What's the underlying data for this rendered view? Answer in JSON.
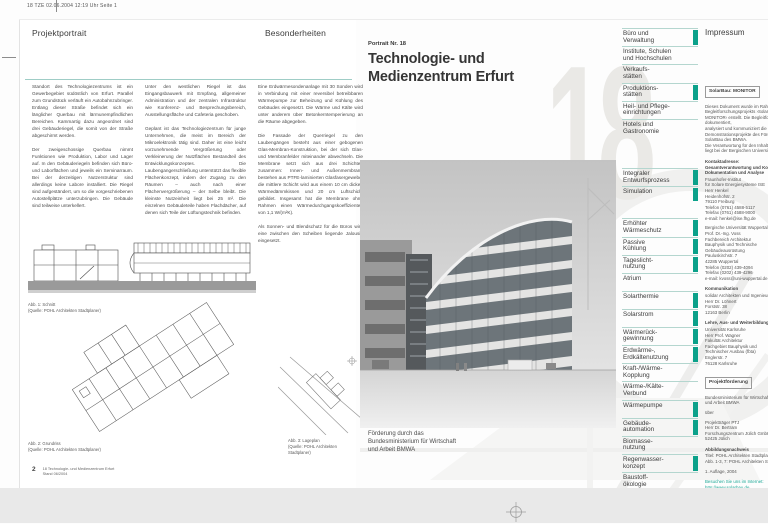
{
  "meta": {
    "print_info": "18 TZE 02.06.2004 12:19 Uhr Seite 1"
  },
  "colors": {
    "accent_green": "#0ba18a",
    "hairline_teal": "#9fcdc6",
    "link_teal": "#1aa795",
    "watermark_gray": "#eae9e6",
    "desk_gray": "#e9e9e9"
  },
  "left_page": {
    "header_left": "Projektportrait",
    "header_right": "Besonderheiten",
    "col1": {
      "p1": "Standort des Technologiezentrums ist ein Gewerbegebiet südöstlich von Erfurt. Parallel zum Grundstück verläuft ein Autobahnzubringer. Entlang dieser Straße befindet sich ein länglicher Querbau mit lärmunempfindlichen Bereichen. Kammartig dazu angeordnet sind drei Gebäuderiegel, die somit von der Straße abgeschirmt werden.",
      "p2": "Der zweigeschossige Querbau nimmt Funktionen wie Produktion, Labor und Lager auf. In den Gebäuderiegeln befinden sich Büro- und Laborflächen und jeweils ein Seminarraum. Bei der derzeitigen Nutzerstruktur sind allerdings keine Labore installiert. Die Riegel sind aufgeständert, um so die vorgeschriebenen Autostellplätze unterzubringen. Die Gebäude sind teilweise unterkellert."
    },
    "col2": {
      "p1": "Unter den westlichen Riegel ist das Eingangsbauwerk mit Empfang, allgemeiner Administration und der zentralen Infrastruktur wie Konferenz- und Besprechungsbereich, Ausstellungsfläche und Cafeteria geschoben.",
      "p2": "Geplant ist das Technologiezentrum für junge Unternehmen, die meist im Bereich der Mikroelektronik tätig sind. Daher ist eine leicht vorzunehmende Vergrößerung oder Verkleinerung der Nutzflächen Bestandteil des Entwicklungskonzeptes. Die Laubengangerschließung unterstützt das flexible Flächenkonzept, indem der Zugang zu den Räumen – auch nach einer Flächenvergrößerung – der Selbe bleibt. Die kleinste Nutzeinheit liegt bei 25 m². Die einzelnen Gebäudeteile haben Flachdächer, auf denen sich Teile der Lüftungstechnik befinden."
    },
    "col3": {
      "p1": "Eine Erdwärmesondenanlage mit 30 Sonden wird in Verbindung mit einer reversibel betreibbaren Wärmepumpe zur Beheizung und Kühlung des Gebäudes eingesetzt. Die Wärme und Kälte wird unter anderem über Betonkerntemperierung an die Räume abgegeben.",
      "p2": "Die Fassade der Querriegel zu den Laubengängen besteht aus einer gebogenen Glas-Membran-Konstruktion, bei der sich Glas- und Membranfelder miteinander abwechseln. Die Membrane setzt sich aus drei Schichten zusammen: Innen- und Außenmembrane bestehen aus PTFE-laminierten Glasfasergewebe, die mittlere Schicht wird aus einem 10 cm dicken Wärmedämmkissen und 20 cm Luftschicht gebildet. Insgesamt hat die Membrane ohne Rahmen einen Wärmedurchgangskoeffizienten von 1,1 W/(m²K).",
      "p3": "Als Sonnen- und Blendschutz für die Büros wird eine zwischen den Scheiben liegende Jalousie eingesetzt."
    },
    "fig1_caption": "Abb. 1: Schnitt\n(Quelle: POHL Architekten Stadtplaner)",
    "fig2_caption": "Abb. 2: Grundriss\n(Quelle: POHL Architekten Stadtplaner)",
    "fig3_caption": "Abb. 3: Lageplan\n(Quelle: POHL Architekten\nStadtplaner)",
    "page_number": "2",
    "footer_lines": "18 Technologie- und Medienzentrum Erfurt\nStand 06/2004"
  },
  "right_page": {
    "kicker": "Portrait Nr. 18",
    "title": "Technologie- und\nMedienzentrum Erfurt",
    "watermark": "18",
    "funding_note": "Förderung durch das\nBundesministerium für Wirtschaft\nund Arbeit BMWA"
  },
  "sidebar": {
    "building_types": [
      {
        "label": "Büro und\nVerwaltung",
        "active": true
      },
      {
        "label": "Institute, Schulen\nund Hochschulen",
        "active": false
      },
      {
        "label": "Verkaufs-\nstätten",
        "active": false
      },
      {
        "label": "Produktions-\nstätten",
        "active": true
      },
      {
        "label": "Heil- und Pflege-\neinrichtungen",
        "active": false
      },
      {
        "label": "Hotels und\nGastronomie",
        "active": false
      }
    ],
    "process": [
      {
        "label": "Integraler\nEntwurfsprozess",
        "active": true
      },
      {
        "label": "Simulation",
        "active": true
      }
    ],
    "features": [
      {
        "label": "Erhöhter\nWärmeschutz",
        "active": true
      },
      {
        "label": "Passive\nKühlung",
        "active": true
      },
      {
        "label": "Tageslicht-\nnutzung",
        "active": true
      },
      {
        "label": "Atrium",
        "active": false
      },
      {
        "label": "Solarthermie",
        "active": true
      },
      {
        "label": "Solarstrom",
        "active": true
      },
      {
        "label": "Wärmerück-\ngewinnung",
        "active": true
      },
      {
        "label": "Erdwärme-,\nErdkältenutzung",
        "active": true
      },
      {
        "label": "Kraft-/Wärme-\nKopplung",
        "active": false
      },
      {
        "label": "Wärme-/Kälte-\nVerbund",
        "active": false
      },
      {
        "label": "Wärmepumpe",
        "active": true
      },
      {
        "label": "Gebäude-\nautomation",
        "active": true
      },
      {
        "label": "Biomasse-\nnutzung",
        "active": false
      },
      {
        "label": "Regenwasser-\nkonzept",
        "active": true
      },
      {
        "label": "Baustoff-\nökologie",
        "active": false
      }
    ]
  },
  "impressum": {
    "title": "Impressum",
    "sections": [
      {
        "cls": "box",
        "text": "SolarBau: MONITOR"
      },
      {
        "cls": "p",
        "text": "Dieses Dokument wurde im Rahmen des\nBegleitforschungsprojekts ›SolarBau:\nMONITOR‹ erstellt. Die Begleitforschung dokumentiert,\nanalysiert und kommuniziert die\nDemonstrationsprojekte des Förderkonzepts\nSolarBau des BMWA.\nDie Verantwortung für den Inhalt\nliegt bei der Bergischen Universität."
      },
      {
        "cls": "h",
        "text": "Kontaktadresse:\nGesamtverantwortung und Koordination,\nDokumentation und Analyse"
      },
      {
        "cls": "p",
        "text": "Fraunhofer-Institut\nfür Solare Energiesysteme ISE\nHerr Henkel\nHeidenhofstr. 2\n79110 Freiburg\nTelefon (0761) 4588-5117\nTelefax (0761) 4588-9000\ne-mail: henkel@ise.fhg.de"
      },
      {
        "cls": "p",
        "text": "Bergische Universität Wuppertal\nProf. Dr.-Ing. Voss\nFachbereich Architektur\nBauphysik und Technische Gebäudeausrüstung\nPauluskirchstr. 7\n42285 Wuppertal\nTelefon (0202) 439-4094\nTelefax (0202) 439-4296\ne-mail: kvoss@uni-wuppertal.de"
      },
      {
        "cls": "h",
        "text": "Kommunikation"
      },
      {
        "cls": "p",
        "text": "solidar Architekten und Ingenieure\nHerr Dr. Löhnert\nForststr. 38\n12163 Berlin"
      },
      {
        "cls": "h",
        "text": "Lehre, Aus- und Weiterbildung"
      },
      {
        "cls": "p",
        "text": "Universität Karlsruhe\nHerr Prof. Wagner\nFakultät Architektur\nFachgebiet Bauphysik und\nTechnischer Ausbau (fbta)\nEnglerstr. 7\n76128 Karlsruhe"
      },
      {
        "cls": "box",
        "text": "Projektförderung"
      },
      {
        "cls": "p",
        "text": "Bundesministerium für Wirtschaft\nund Arbeit BMWA"
      },
      {
        "cls": "p",
        "text": "über"
      },
      {
        "cls": "p",
        "text": "Projektträger PTJ\nHerr Dr. Bertram\nForschungszentrum Jülich GmbH\n52425 Jülich"
      },
      {
        "cls": "h",
        "text": "Abbildungsnachweis"
      },
      {
        "cls": "p",
        "text": "Titel: POHL Architekten Stadtplaner\nAbb. 1-3, 7: POHL Architekten Stadtplaner"
      },
      {
        "cls": "p",
        "text": "1. Auflage, 2004"
      },
      {
        "cls": "link",
        "text": "Besuchen Sie uns im Internet:\nhttp://www.solarbau.de"
      }
    ]
  }
}
